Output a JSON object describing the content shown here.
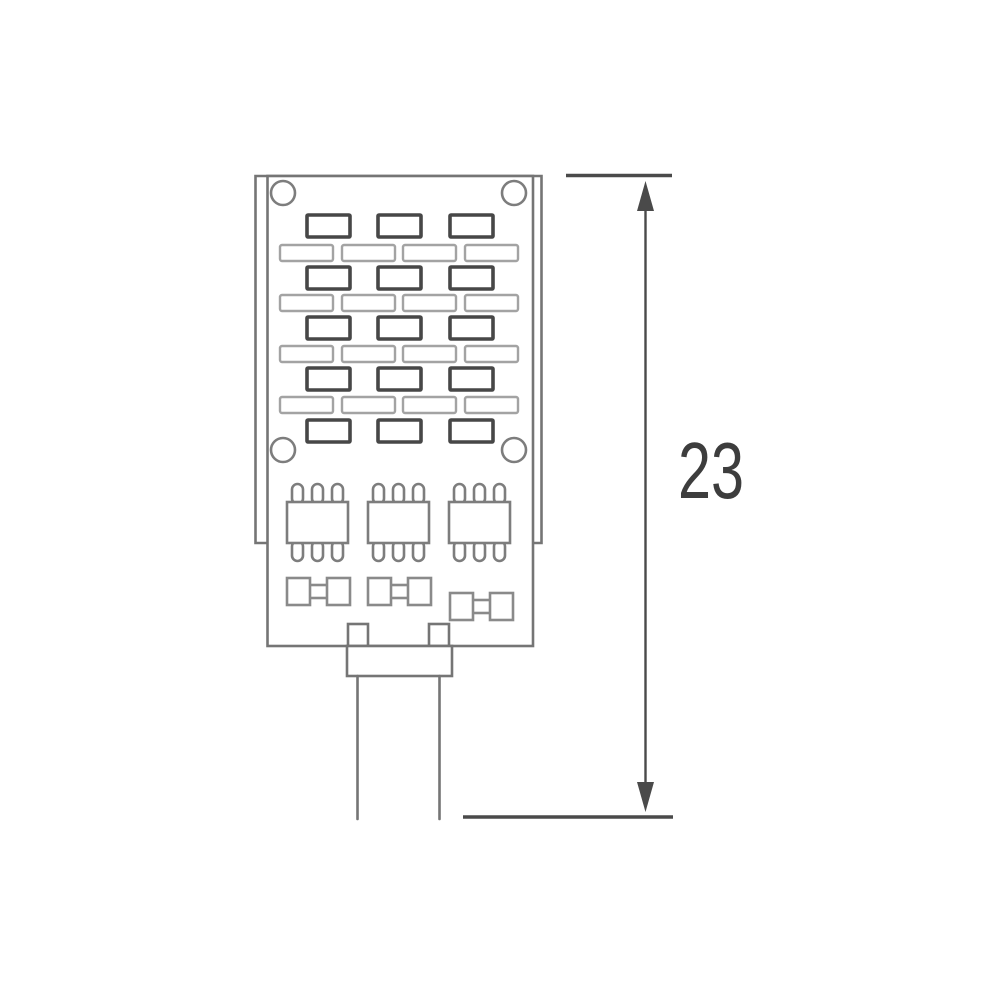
{
  "diagram": {
    "kind": "technical-dimension-drawing",
    "subject": "LED lamp module profile with height dimension",
    "background_color": "#ffffff",
    "dimension": {
      "label": "23",
      "orientation": "vertical",
      "arrow_style": "double-headed filled triangles with extension lines"
    },
    "colors": {
      "body_line": "#757575",
      "led_dark_line": "#474747",
      "led_light_line": "#a3a3a3",
      "ic_line": "#7d7d7d",
      "component_line": "#8a8a8a",
      "dimension_line": "#4a4a4a",
      "label_text": "#3d3d3d"
    },
    "components": {
      "screw_holes": 4,
      "led_chips_dark": 15,
      "led_chips_light": 16,
      "ic_chips": 3,
      "smd_components": 3,
      "mounting_tabs": 2,
      "connector": "neck with two-lead pin stem"
    }
  }
}
